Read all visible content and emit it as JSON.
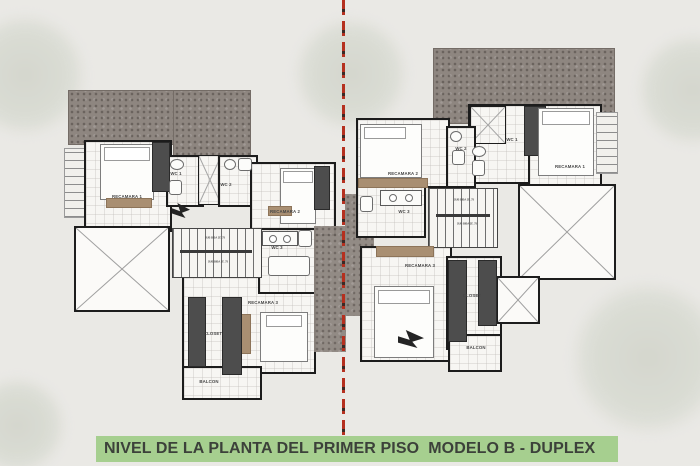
{
  "title": {
    "text": "NIVEL DE LA PLANTA DEL PRIMER PISO  MODELO B - DUPLEX",
    "bg_color": "#a6cf8f",
    "text_color": "#3c413a"
  },
  "divider": {
    "style": "dashed",
    "color": "#b5301f"
  },
  "palette": {
    "background": "#eae9e5",
    "roof_hatch": "#8e8680",
    "walls": "#1c1c1c",
    "room_floor": "#f7f6f3",
    "wood_accent": "#a98f72",
    "closet_fill": "#4d4d4d"
  },
  "labels": {
    "left": {
      "recamara1": "RECAMARA 1",
      "wc1": "WC 1",
      "wc2": "WC 2",
      "recamara2": "RECAMARA 2",
      "wc3": "WC 3",
      "recamara3": "RECAMARA 3",
      "closet": "CLOSET",
      "balcon": "BALCON",
      "stair_note_a": "SUB BIBA JE .75",
      "stair_note_b": "SUB BIBA JE .75"
    },
    "right": {
      "recamara1": "RECAMARA 1",
      "wc1": "WC 1",
      "wc2": "WC 2",
      "recamara2": "RECAMARA 2",
      "wc3": "WC 3",
      "recamara3": "RECAMARA 3",
      "closet": "CLOSET",
      "balcon": "BALCON",
      "stair_note_a": "SUB BIBA JE .75",
      "stair_note_b": "SUB BIBA JE .75"
    }
  }
}
